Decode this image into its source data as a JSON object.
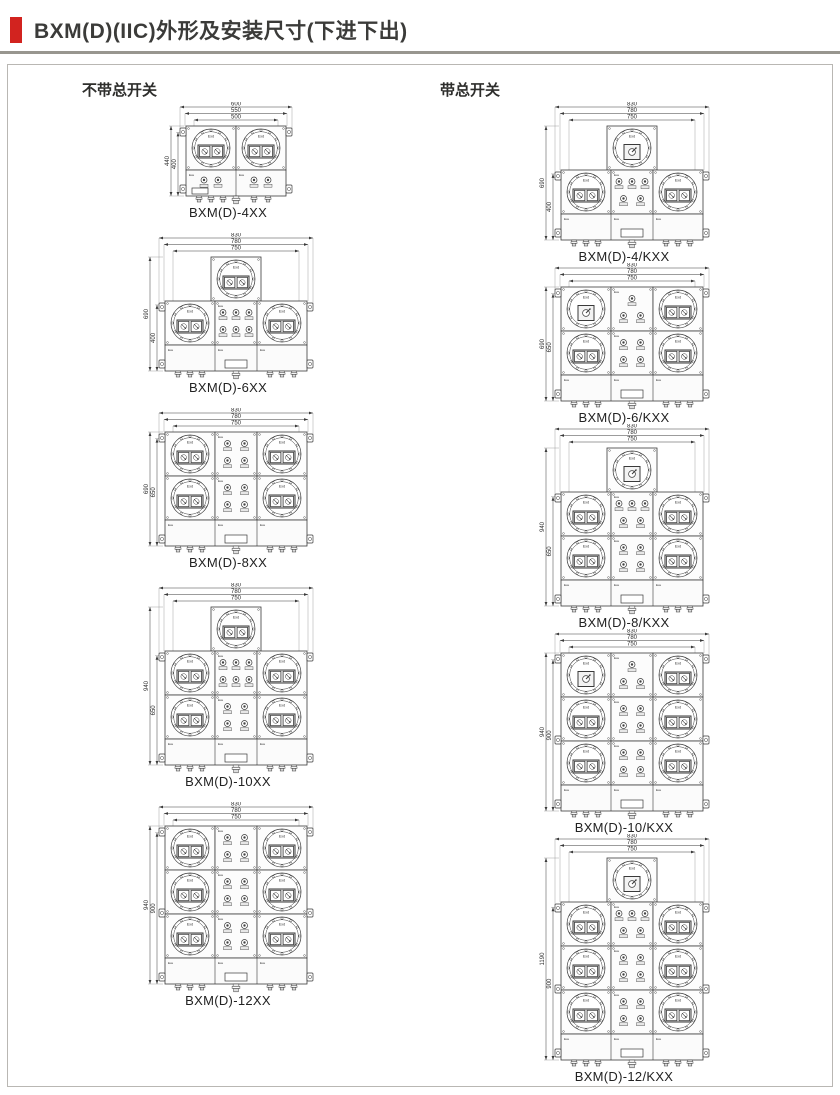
{
  "header": {
    "title": "BXM(D)(IIC)外形及安装尺寸(下进下出)",
    "accent_color": "#d2231f",
    "rule_color": "#98968f"
  },
  "sections": {
    "left_label": "不带总开关",
    "right_label": "带总开关"
  },
  "labels": {
    "exd": "Exd",
    "exe": "Exe"
  },
  "diagrams": {
    "left": [
      {
        "caption": "BXM(D)-4XX",
        "top_dims": [
          "600",
          "550",
          "500"
        ],
        "left_dims": [
          "440",
          "400"
        ],
        "kind": "pair"
      },
      {
        "caption": "BXM(D)-6XX",
        "top_dims": [
          "830",
          "780",
          "750"
        ],
        "left_dims": [
          "690",
          "400"
        ],
        "kind": "rows",
        "top_unit": "sockets",
        "rows": [
          {
            "left": "s2",
            "mid": [
              3,
              3
            ],
            "right": "s2"
          }
        ]
      },
      {
        "caption": "BXM(D)-8XX",
        "top_dims": [
          "830",
          "780",
          "750"
        ],
        "left_dims": [
          "690",
          "650"
        ],
        "kind": "rows",
        "top_unit": null,
        "rows": [
          {
            "left": "s2",
            "mid": [
              2,
              2
            ],
            "right": "s2"
          },
          {
            "left": "s2",
            "mid": [
              2,
              2
            ],
            "right": "s2"
          }
        ]
      },
      {
        "caption": "BXM(D)-10XX",
        "top_dims": [
          "830",
          "780",
          "750"
        ],
        "left_dims": [
          "940",
          "650"
        ],
        "kind": "rows",
        "top_unit": "sockets",
        "rows": [
          {
            "left": "s2",
            "mid": [
              3,
              3
            ],
            "right": "s2"
          },
          {
            "left": "s2",
            "mid": [
              2,
              2
            ],
            "right": "s2"
          }
        ]
      },
      {
        "caption": "BXM(D)-12XX",
        "top_dims": [
          "830",
          "780",
          "750"
        ],
        "left_dims": [
          "940",
          "900"
        ],
        "kind": "rows",
        "top_unit": null,
        "rows": [
          {
            "left": "s2",
            "mid": [
              2,
              2
            ],
            "right": "s2"
          },
          {
            "left": "s2",
            "mid": [
              2,
              2
            ],
            "right": "s2"
          },
          {
            "left": "s2",
            "mid": [
              2,
              2
            ],
            "right": "s2"
          }
        ]
      }
    ],
    "right": [
      {
        "caption": "BXM(D)-4/KXX",
        "top_dims": [
          "830",
          "780",
          "750"
        ],
        "left_dims": [
          "690",
          "400"
        ],
        "kind": "rows",
        "top_unit": "switch",
        "rows": [
          {
            "left": "s2",
            "mid": [
              3,
              2
            ],
            "right": "s2"
          }
        ]
      },
      {
        "caption": "BXM(D)-6/KXX",
        "top_dims": [
          "830",
          "780",
          "750"
        ],
        "left_dims": [
          "690",
          "650"
        ],
        "kind": "rows",
        "top_unit": null,
        "rows": [
          {
            "left": "sw",
            "mid": [
              1,
              2
            ],
            "right": "s2"
          },
          {
            "left": "s2",
            "mid": [
              2,
              2
            ],
            "right": "s2"
          }
        ]
      },
      {
        "caption": "BXM(D)-8/KXX",
        "top_dims": [
          "830",
          "780",
          "750"
        ],
        "left_dims": [
          "940",
          "650"
        ],
        "kind": "rows",
        "top_unit": "switch",
        "rows": [
          {
            "left": "s2",
            "mid": [
              3,
              2
            ],
            "right": "s2"
          },
          {
            "left": "s2",
            "mid": [
              2,
              2
            ],
            "right": "s2"
          }
        ]
      },
      {
        "caption": "BXM(D)-10/KXX",
        "top_dims": [
          "830",
          "780",
          "750"
        ],
        "left_dims": [
          "940",
          "900"
        ],
        "kind": "rows",
        "top_unit": null,
        "rows": [
          {
            "left": "sw",
            "mid": [
              1,
              2
            ],
            "right": "s2"
          },
          {
            "left": "s2",
            "mid": [
              2,
              2
            ],
            "right": "s2"
          },
          {
            "left": "s2",
            "mid": [
              2,
              2
            ],
            "right": "s2"
          }
        ]
      },
      {
        "caption": "BXM(D)-12/KXX",
        "top_dims": [
          "830",
          "780",
          "750"
        ],
        "left_dims": [
          "1190",
          "900"
        ],
        "kind": "rows",
        "top_unit": "switch",
        "rows": [
          {
            "left": "s2",
            "mid": [
              3,
              2
            ],
            "right": "s2"
          },
          {
            "left": "s2",
            "mid": [
              2,
              2
            ],
            "right": "s2"
          },
          {
            "left": "s2",
            "mid": [
              2,
              2
            ],
            "right": "s2"
          }
        ]
      }
    ]
  }
}
